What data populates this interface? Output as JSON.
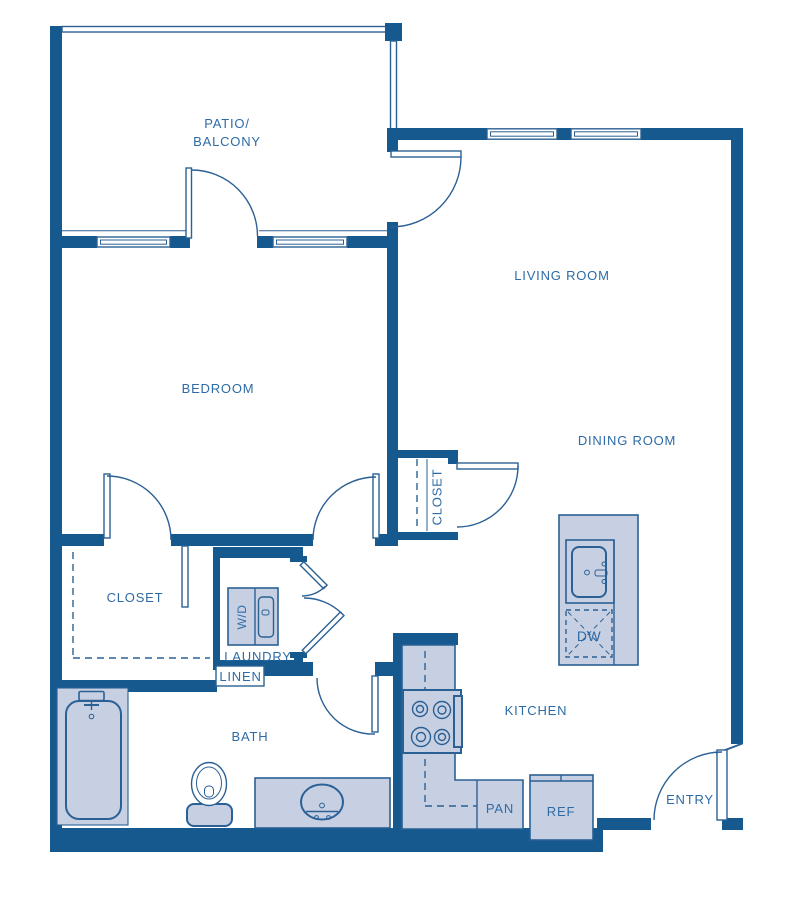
{
  "title": "One-bedroom apartment floor plan",
  "colors": {
    "wall": "#15598e",
    "line": "#2b6095",
    "fixture_fill": "#c7d0e2",
    "label_text": "#2e6ba6",
    "background": "#ffffff"
  },
  "rooms": {
    "patio_line1": "PATIO/",
    "patio_line2": "BALCONY",
    "living_room": "LIVING ROOM",
    "bedroom": "BEDROOM",
    "dining_room": "DINING ROOM",
    "kitchen": "KITCHEN",
    "bath": "BATH",
    "entry": "ENTRY",
    "laundry": "LAUNDRY",
    "bedroom_closet": "CLOSET",
    "hall_closet": "CLOSET"
  },
  "fixtures": {
    "washer_dryer": "W/D",
    "linen": "LINEN",
    "pantry": "PAN",
    "refrigerator": "REF",
    "dishwasher": "DW"
  }
}
